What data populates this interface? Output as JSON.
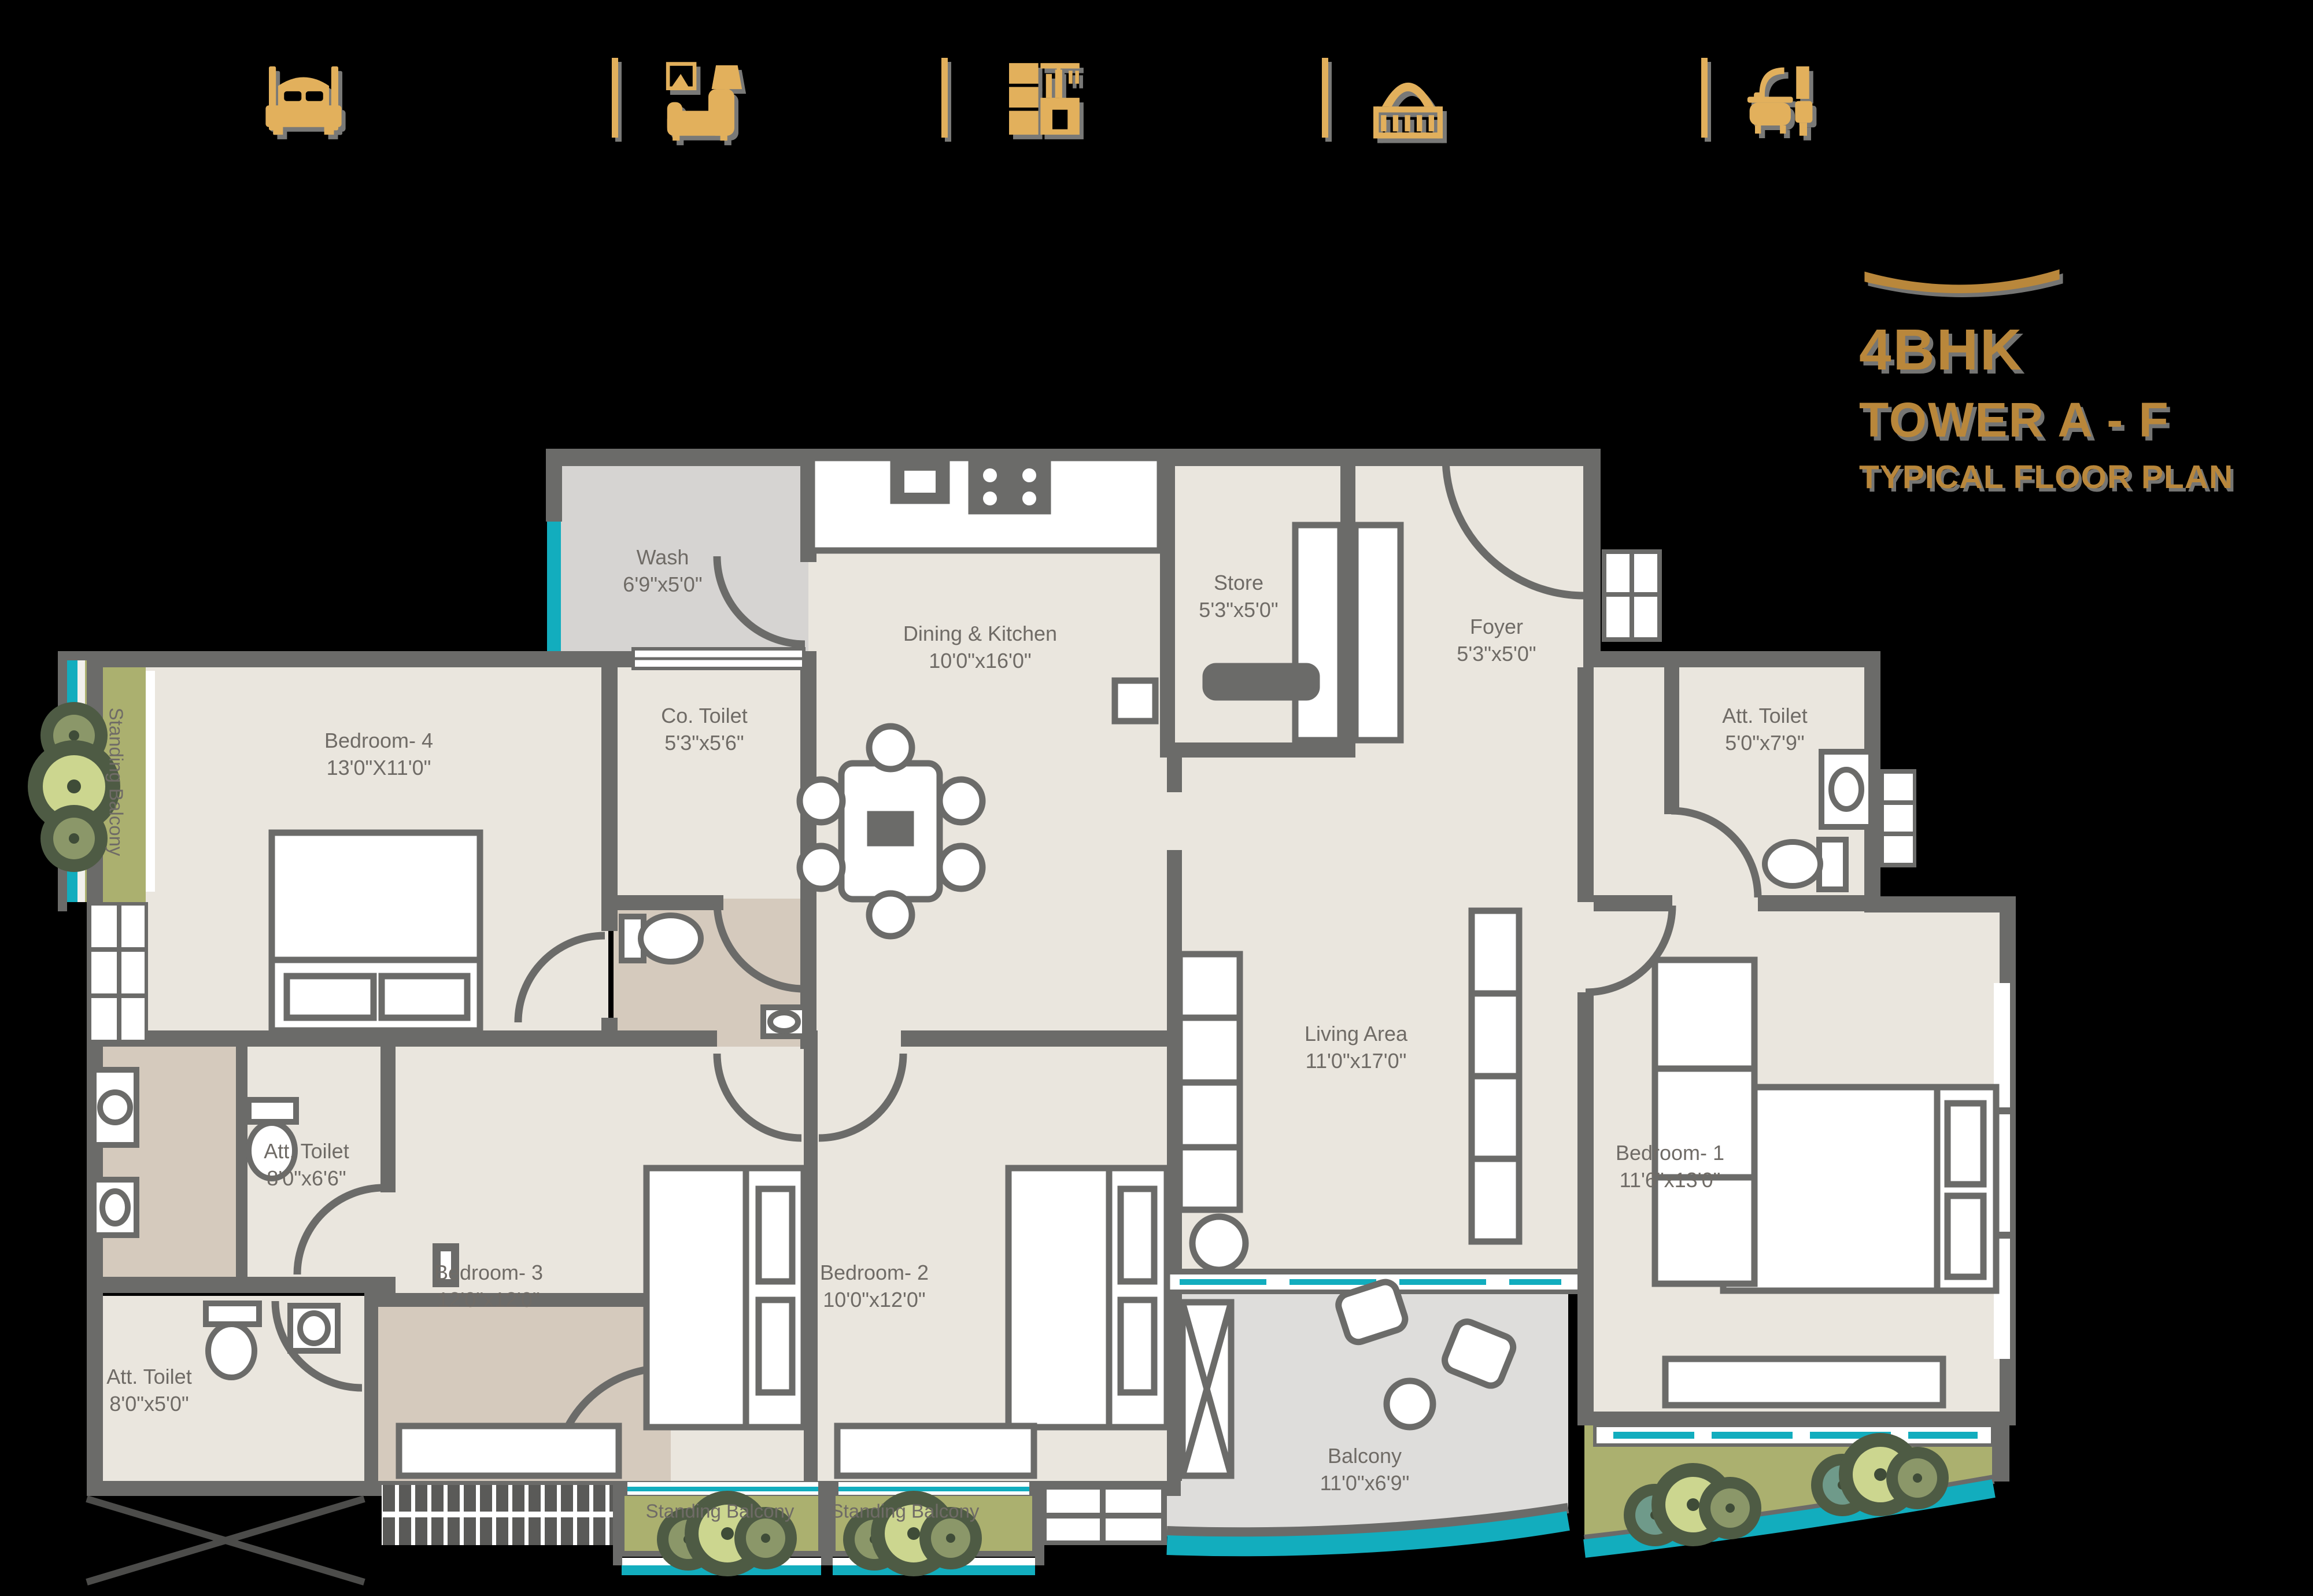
{
  "title": {
    "line1": "4BHK",
    "line2": "TOWER A - F",
    "line3": "TYPICAL FLOOR PLAN"
  },
  "amenities": {
    "icons": [
      {
        "name": "bed-icon"
      },
      {
        "name": "armchair-icon"
      },
      {
        "name": "kitchen-icon"
      },
      {
        "name": "balcony-icon"
      },
      {
        "name": "bathtub-icon"
      }
    ]
  },
  "rooms": [
    {
      "id": "wash",
      "name": "Wash",
      "dims": "6'9\"x5'0\""
    },
    {
      "id": "dining-kitchen",
      "name": "Dining & Kitchen",
      "dims": "10'0\"x16'0\""
    },
    {
      "id": "store",
      "name": "Store",
      "dims": "5'3\"x5'0\""
    },
    {
      "id": "foyer",
      "name": "Foyer",
      "dims": "5'3\"x5'0\""
    },
    {
      "id": "att-toilet-bedroom1",
      "name": "Att. Toilet",
      "dims": "5'0\"x7'9\""
    },
    {
      "id": "bedroom-4",
      "name": "Bedroom- 4",
      "dims": "13'0\"X11'0\""
    },
    {
      "id": "co-toilet",
      "name": "Co. Toilet",
      "dims": "5'3\"x5'6\""
    },
    {
      "id": "standing-balcony-left",
      "name": "Standing Balcony",
      "dims": ""
    },
    {
      "id": "att-toilet-bedroom3",
      "name": "Att. Toilet",
      "dims": "8'0\"x6'6\""
    },
    {
      "id": "bedroom-3",
      "name": "Bedroom- 3",
      "dims": "12'0\"x12'0\""
    },
    {
      "id": "bedroom-2",
      "name": "Bedroom- 2",
      "dims": "10'0\"x12'0\""
    },
    {
      "id": "living-area",
      "name": "Living Area",
      "dims": "11'0\"x17'0\""
    },
    {
      "id": "bedroom-1",
      "name": "Bedroom- 1",
      "dims": "11'6\"x13'0\""
    },
    {
      "id": "att-toilet-2",
      "name": "Att. Toilet",
      "dims": "8'0\"x5'0\""
    },
    {
      "id": "balcony",
      "name": "Balcony",
      "dims": "11'0\"x6'9\""
    },
    {
      "id": "standing-balcony-1",
      "name": "Standing Balcony",
      "dims": ""
    },
    {
      "id": "standing-balcony-2",
      "name": "Standing Balcony",
      "dims": ""
    }
  ],
  "colors": {
    "icon_gold": "#e2b05c",
    "title_gold": "#b9873b",
    "wall_gray": "#6b6b69",
    "floor_beige": "#eae6de",
    "floor_tan": "#d5cabd",
    "floor_gray": "#d6d4d2",
    "balcony_green": "#abb06f",
    "water_teal": "#12adbe",
    "label_gray": "#6f6b66"
  }
}
